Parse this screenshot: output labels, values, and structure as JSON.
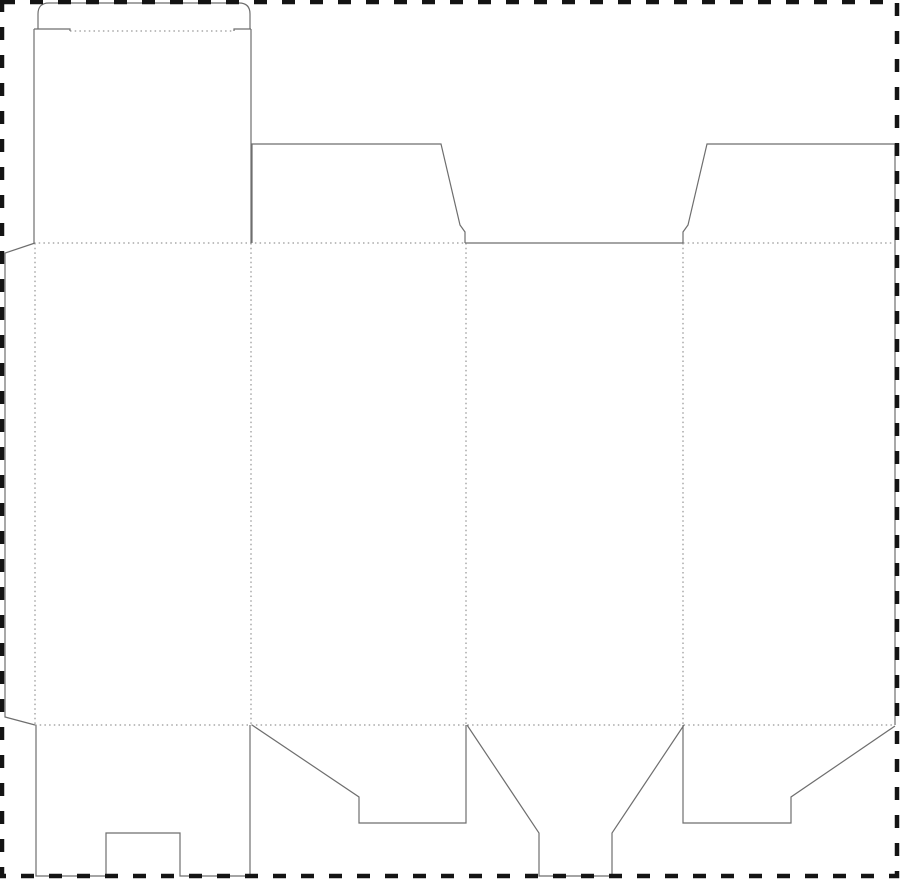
{
  "canvas": {
    "width": 900,
    "height": 881,
    "background": "#ffffff"
  },
  "colors": {
    "cut_line": "#6e6e6e",
    "fold_line": "#7d7d7d",
    "border_line": "#141414",
    "background": "#ffffff"
  },
  "strokes": {
    "cut": {
      "width": 1.2,
      "dash": ""
    },
    "fold": {
      "width": 1,
      "dash": "1.5 3.2"
    },
    "border": {
      "width": 4.5,
      "dash": "13 15"
    }
  },
  "dieline": {
    "border": {
      "name": "bleed-border",
      "x": 2,
      "y": 2,
      "w": 895,
      "h": 874
    },
    "paths": [
      {
        "name": "tuck-flap-outline",
        "type": "cut",
        "d": "M 38,29 V 14 Q 38,3 49,3 H 239 Q 250,3 250,14 V 29"
      },
      {
        "name": "tuck-left-shoulder",
        "type": "cut",
        "d": "M 34,29 H 70 V 31"
      },
      {
        "name": "tuck-right-shoulder",
        "type": "cut",
        "d": "M 234,31 V 29 H 251"
      },
      {
        "name": "lid-left-edge",
        "type": "cut",
        "d": "M 34,29 V 243"
      },
      {
        "name": "lid-right-edge",
        "type": "cut",
        "d": "M 251,29 V 243"
      },
      {
        "name": "top-dust-flap-left",
        "type": "cut",
        "d": "M 252,243 V 144 H 441 L 460,225 L 465,232 V 243"
      },
      {
        "name": "panel3-top-cut",
        "type": "cut",
        "d": "M 465,243 H 683"
      },
      {
        "name": "top-dust-flap-right",
        "type": "cut",
        "d": "M 683,243 V 232 L 688,225 L 707,144 H 895"
      },
      {
        "name": "right-side-cut",
        "type": "cut",
        "d": "M 895,144 V 725"
      },
      {
        "name": "glue-flap-outline",
        "type": "cut",
        "d": "M 35,243 L 5,253 V 717 L 35,725"
      },
      {
        "name": "bottom-flap-1-outline",
        "type": "cut",
        "d": "M 36,725 V 876 H 106 V 833 H 180 V 876 H 250 V 725"
      },
      {
        "name": "bottom-flap-2-outline",
        "type": "cut",
        "d": "M 252,725 L 359,797 V 823 H 466 V 725"
      },
      {
        "name": "bottom-flap-3-outline",
        "type": "cut",
        "d": "M 467,725 L 539,833 V 876 H 612 V 833 L 684,725"
      },
      {
        "name": "bottom-flap-4-outline",
        "type": "cut",
        "d": "M 683,725 V 823 H 791 V 797 L 895,726"
      },
      {
        "name": "tuck-fold",
        "type": "fold",
        "d": "M 70,31 H 234"
      },
      {
        "name": "top-fold-panel1-panel2",
        "type": "fold",
        "d": "M 34,243 H 465"
      },
      {
        "name": "top-fold-panel4",
        "type": "fold",
        "d": "M 683,243 H 895"
      },
      {
        "name": "bottom-fold",
        "type": "fold",
        "d": "M 35,725 H 895"
      },
      {
        "name": "glue-flap-fold",
        "type": "fold",
        "d": "M 35,243 V 725"
      },
      {
        "name": "fold-panel1-panel2",
        "type": "fold",
        "d": "M 251,243 V 725"
      },
      {
        "name": "fold-panel2-panel3",
        "type": "fold",
        "d": "M 466,243 V 725"
      },
      {
        "name": "fold-panel3-panel4",
        "type": "fold",
        "d": "M 683,243 V 725"
      }
    ]
  }
}
